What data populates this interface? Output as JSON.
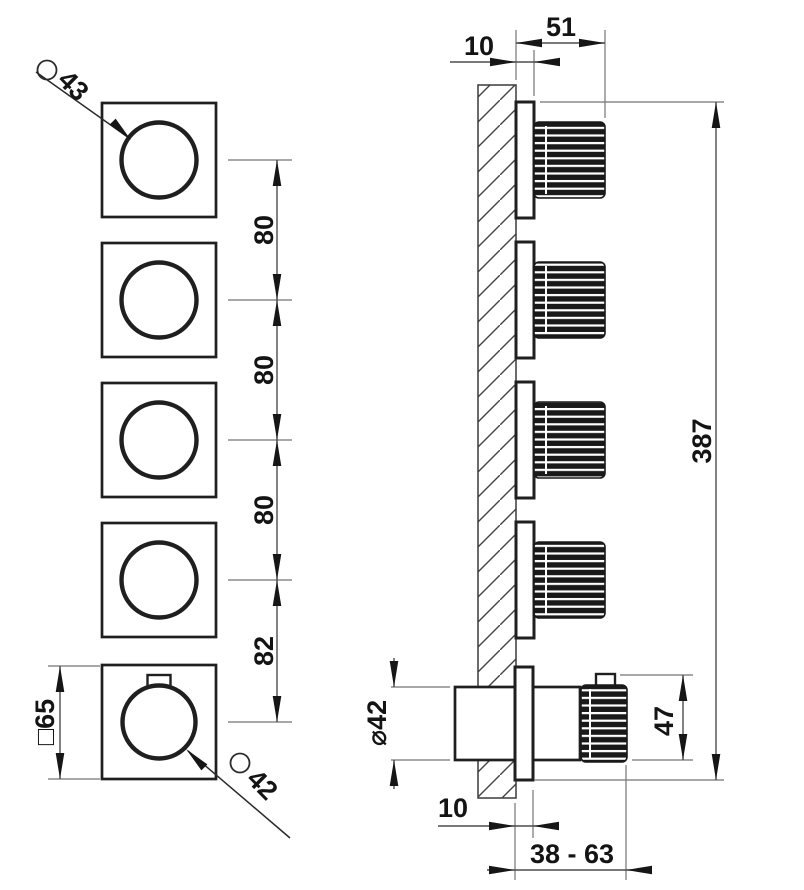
{
  "drawing": {
    "front_view": {
      "top_knob": {
        "symbol": "⌀",
        "value": "43"
      },
      "bottom_knob": {
        "symbol": "⌀",
        "value": "42"
      },
      "plate_label": "□65",
      "spacings": [
        "80",
        "80",
        "80",
        "82"
      ]
    },
    "side_view": {
      "plate_thickness_top": "10",
      "knob_protrusion": "51",
      "total_height": "387",
      "body_diameter": "⌀42",
      "handle_height": "47",
      "plate_thickness_bottom": "10",
      "depth_range": "38 - 63"
    },
    "colors": {
      "line": "#1f1f1f",
      "background": "#ffffff",
      "knob_fill": "#191919"
    }
  }
}
